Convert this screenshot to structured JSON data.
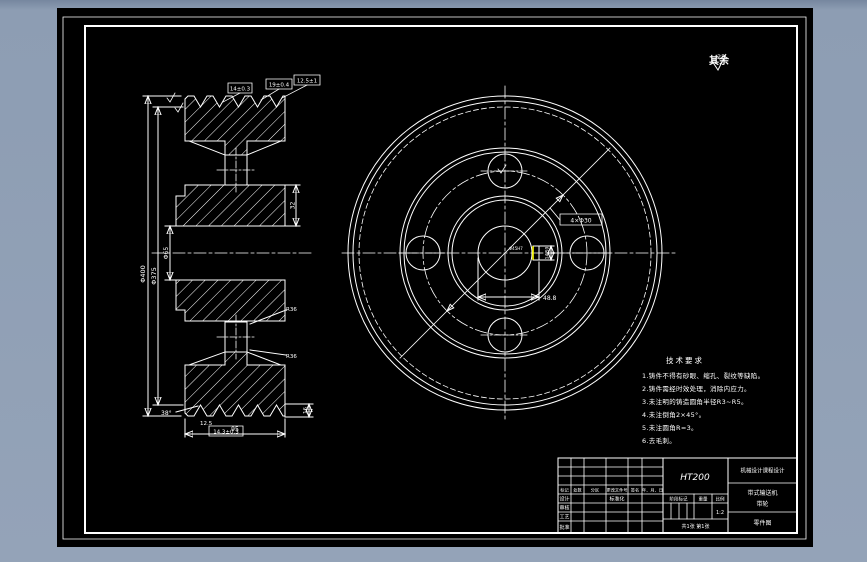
{
  "colors": {
    "canvas_bg": "#8d9db3",
    "sheet_bg": "#000000",
    "line": "#ffffff",
    "highlight": "#ffff00"
  },
  "surface_note": {
    "label": "其余",
    "value": "25"
  },
  "tech_notes": {
    "title": "技术要求",
    "lines": [
      "1.铸件不得有砂眼、缩孔、裂纹等缺陷。",
      "2.铸件需经时效处理，消除内应力。",
      "3.未注明的铸造圆角半径R3~R5。",
      "4.未注倒角2×45°。",
      "5.未注圆角R=3。",
      "6.去毛刺。"
    ]
  },
  "left_view": {
    "dim_outer": "Φ400",
    "dim_pitch": "Φ375",
    "dim_bore": "Φ65",
    "box_dims": [
      "14±0.3",
      "19±0.4",
      "12.5±1"
    ],
    "groove_angle": "38°",
    "side_dim": "32",
    "fillet_top": "R36",
    "fillet_bottom": "R36",
    "width_dim": "95",
    "pitch_box": "14.3±0.3",
    "small_dim": "12.5",
    "tooth_dim": "16"
  },
  "right_view": {
    "holes_label": "4×Φ30",
    "keyway_width": "14JS9",
    "keyway_depth": "48.8",
    "bore_dim": "Φ45H7"
  },
  "title_block": {
    "material": "HT200",
    "header": [
      "标记",
      "处数",
      "分区",
      "更改文件号",
      "签名",
      "年、月、日"
    ],
    "row_labels": [
      "设计",
      "审核",
      "工艺",
      "批准"
    ],
    "standardization": "标准化",
    "stage_label": "阶段标记",
    "weight_label": "重量",
    "scale_label": "比例",
    "scale_value": "1:2",
    "sheet_info": "共1张 第1张",
    "org": "机械设计课程设计",
    "product": "带式输送机",
    "part_name": "带轮",
    "doc_type": "零件图"
  }
}
